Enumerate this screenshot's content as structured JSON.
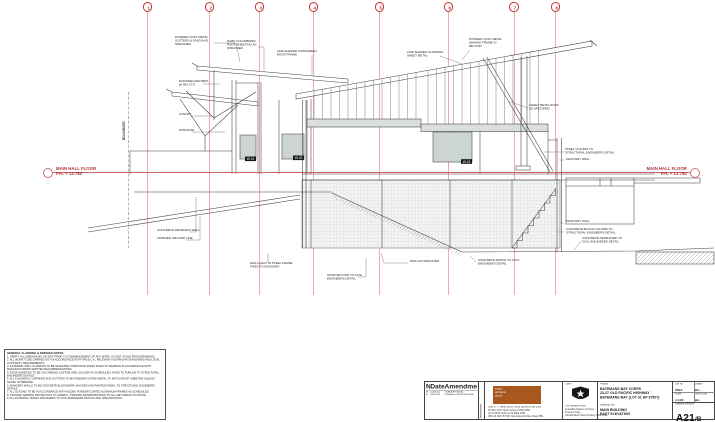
{
  "sheet": {
    "drawing_type": "east elevation architectural drawing",
    "boundary_label": "BOUNDARY"
  },
  "colors": {
    "grid_line": "#f0aaaa",
    "grid_bubble": "#c43030",
    "floor_line": "#d06464",
    "linework": "#3f3f3f",
    "window_fill": "#cdd4d4",
    "band_fill": "#dadedd",
    "logo_orange": "#a8571f"
  },
  "grid": {
    "items": [
      {
        "label": "1",
        "x": 147.5
      },
      {
        "label": "2",
        "x": 209.5
      },
      {
        "label": "3",
        "x": 259.5
      },
      {
        "label": "4",
        "x": 313.5
      },
      {
        "label": "5",
        "x": 379.5
      },
      {
        "label": "6",
        "x": 448.5
      },
      {
        "label": "7",
        "x": 514
      },
      {
        "label": "8",
        "x": 555.5
      }
    ]
  },
  "floor_levels": {
    "left": {
      "title": "MAIN HALL FLOOR",
      "level": "FFL + 13.780"
    },
    "right": {
      "title": "MAIN HALL FLOOR",
      "level": "FFL + 13.780"
    }
  },
  "windows": {
    "tags": [
      "W-01",
      "W-02",
      "W-03"
    ]
  },
  "annotations": [
    {
      "x": 175,
      "y": 36,
      "text": "POWDER COAT METAL\nGUTTERS & FASCIA AS\nSPECIFIED"
    },
    {
      "x": 227,
      "y": 40,
      "text": "DARK COLORBOND\nROOF SHEETING AS\nSPECIFIED"
    },
    {
      "x": 277,
      "y": 50,
      "text": "LINE SHADED SUNSCREEN\nROOF FRAME"
    },
    {
      "x": 179,
      "y": 80,
      "text": "EXPOSED RAFTERS\n@ 900 CTS"
    },
    {
      "x": 179,
      "y": 113,
      "text": "CANOPY"
    },
    {
      "x": 179,
      "y": 129,
      "text": "SUNHOOD"
    },
    {
      "x": 469,
      "y": 38,
      "text": "POWDER COAT METAL\nAWNING FRAME IN\nBEYOND"
    },
    {
      "x": 407,
      "y": 51,
      "text": "LINE SHADED CLADDING\nSHEET METAL"
    },
    {
      "x": 529,
      "y": 104,
      "text": "SHEET METAL ROOF\nAS SPECIFIED"
    },
    {
      "x": 565,
      "y": 148,
      "text": "STEEL COLUMN TO\nSTRUCTURAL ENGINEERS DETAIL"
    },
    {
      "x": 566,
      "y": 158,
      "text": "MASONRY WALL"
    },
    {
      "x": 566,
      "y": 220,
      "text": "MASONRY WALL"
    },
    {
      "x": 566,
      "y": 228,
      "text": "CONCRETE BLOCK COLUMN TO\nSTRUCTURAL ENGINEERS DETAIL"
    },
    {
      "x": 582,
      "y": 237,
      "text": "CONCRETE KERB RAMP TO\nCIVIL ENGINEERS DETAIL"
    },
    {
      "x": 478,
      "y": 259,
      "text": "CONCRETE APRON TO CIVIL\nENGINEERS DETAIL"
    },
    {
      "x": 410,
      "y": 260,
      "text": "PATH AS SPECIFIED"
    },
    {
      "x": 327,
      "y": 274,
      "text": "STAIR BEYOND TO CIVIL\nENGINEERS DETAIL"
    },
    {
      "x": 157,
      "y": 229,
      "text": "CONCRETE RETAINING WALL"
    },
    {
      "x": 157,
      "y": 237,
      "text": "FINISHED GROUND LINE"
    },
    {
      "x": 250,
      "y": 262,
      "text": "HIGH LIGHT IN STEEL FRAME\nFIXED TO MASONRY"
    }
  ],
  "notes": {
    "title": "GENERAL CLADDING & FINISHES NOTES",
    "lines": [
      "1. VERIFY ALL DIMENSIONS ON SITE PRIOR TO COMMENCEMENT OF ANY WORK. DO NOT SCALE FROM DRAWINGS.",
      "2. ALL WORK TO BE CARRIED OUT IN ACCORDANCE WITH THE B.C.A., RELEVANT AUSTRALIAN STANDARDS AND LOCAL AUTHORITY REQUIREMENTS.",
      "3. EXTERNAL WALL CLADDING TO BE SELECTED COMPOSITE SHEET FIXED TO FRAMING IN ACCORDANCE WITH MANUFACTURERS WRITTEN RECOMMENDATIONS.",
      "4. ROOF SHEETING TO BE COLORBOND CUSTOM ORB, COLOUR AS SCHEDULED, FIXED TO PURLINS TO STRUCTURAL ENGINEERS DETAILS.",
      "5. ALL FLASHINGS, CAPPINGS AND GUTTERS TO BE POWDER COATED METAL TO MATCH ROOF SHEETING UNLESS NOTED OTHERWISE.",
      "6. MASONRY WALLS TO BE CONCRETE BLOCKWORK, BAGGED AND PAINTED FINISH, TO STRUCTURAL ENGINEERS DETAILS.",
      "7. ALL GLAZING TO BE IN ACCORDANCE WITH AS1288. POWDER COATED ALUMINIUM FRAMES AS SCHEDULED.",
      "8. PROVIDE TERMITE PROTECTION TO AS3660.1. PROVIDE WATERPROOFING TO ALL WET AREAS TO AS3740.",
      "9. ALL EXTERNAL PAVING AND RAMPS TO CIVIL ENGINEERS DETAILS AND SPECIFICATION."
    ]
  },
  "titleblock": {
    "revisions": {
      "headers": [
        "No",
        "Date",
        "Amendment"
      ],
      "rows": [
        [
          "B",
          "21.06.02",
          "TENDER ISSUE"
        ],
        [
          "A",
          "03.05.02",
          "ISSUED FOR APPROVAL"
        ]
      ],
      "side_label": "Amendments"
    },
    "architect": {
      "logo_lines": [
        "studio",
        "architects",
        "pty ltd"
      ],
      "address_lines": [
        "Suite 2, 77 Berry Street, North Sydney NSW 2060",
        "PO Box 1027  North Sydney NSW 2059",
        "ph 02 9922 1344   fax 02 9922 1355",
        "ABN 23 003 257 561  Nominated Architect Reg 4551"
      ]
    },
    "client": {
      "label": "Client",
      "lines": [
        "The Salvation Army",
        "Australian Eastern Territory",
        "Property Trust",
        "140 Elizabeth Street  Sydney NSW 2000"
      ]
    },
    "project": {
      "label": "Project",
      "lines": [
        "BATEMANS BAY CORPS",
        "23-27 OLD PACIFIC HIGHWAY",
        "BATEMANS BAY (LOT 31 DP 37507)"
      ],
      "drawing_label": "Drawing Title",
      "drawing_lines": [
        "MAIN BUILDING",
        "EAST ELEVATION"
      ]
    },
    "info": {
      "cells": [
        {
          "label": "Job No",
          "value": "9913"
        },
        {
          "label": "Drawn",
          "value": "DC"
        },
        {
          "label": "Scale",
          "value": "1:100"
        },
        {
          "label": "Sheet Size",
          "value": "A1"
        }
      ],
      "number_label": "Drawing Number",
      "number": "A21",
      "rev": "/B"
    }
  }
}
